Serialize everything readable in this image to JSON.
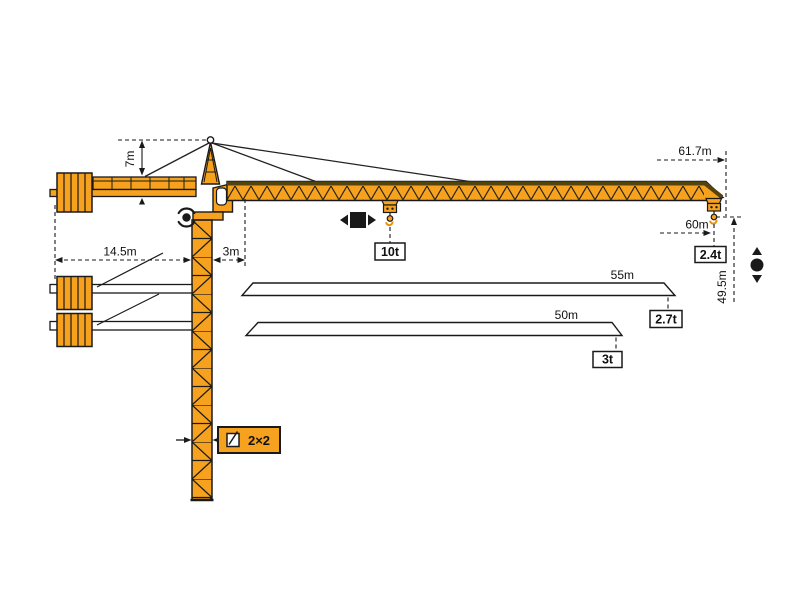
{
  "diagram": {
    "kind": "tower-crane-working-range-diagram",
    "colors": {
      "crane_orange": "#F6A21E",
      "chord_dark": "#55430F",
      "outline_black": "#1A1A1A",
      "background": "#FFFFFF"
    },
    "dimensions": {
      "head_height": "7m",
      "counterjib_radius": "14.5m",
      "min_radius": "3m",
      "jib_length": "61.7m",
      "max_radius": "60m",
      "hook_height": "49.5m",
      "tower_section": "2×2"
    },
    "loads": {
      "max_capacity": "10t",
      "tip_load": "2.4t"
    },
    "jib_options": [
      {
        "length": "55m",
        "tip_load": "2.7t"
      },
      {
        "length": "50m",
        "tip_load": "3t"
      }
    ],
    "icons": {
      "slewing": "rotation-indicator",
      "trolley_travel": "left-right-indicator",
      "hoist": "up-down-indicator",
      "tower_section": "cross-section-symbol"
    }
  }
}
